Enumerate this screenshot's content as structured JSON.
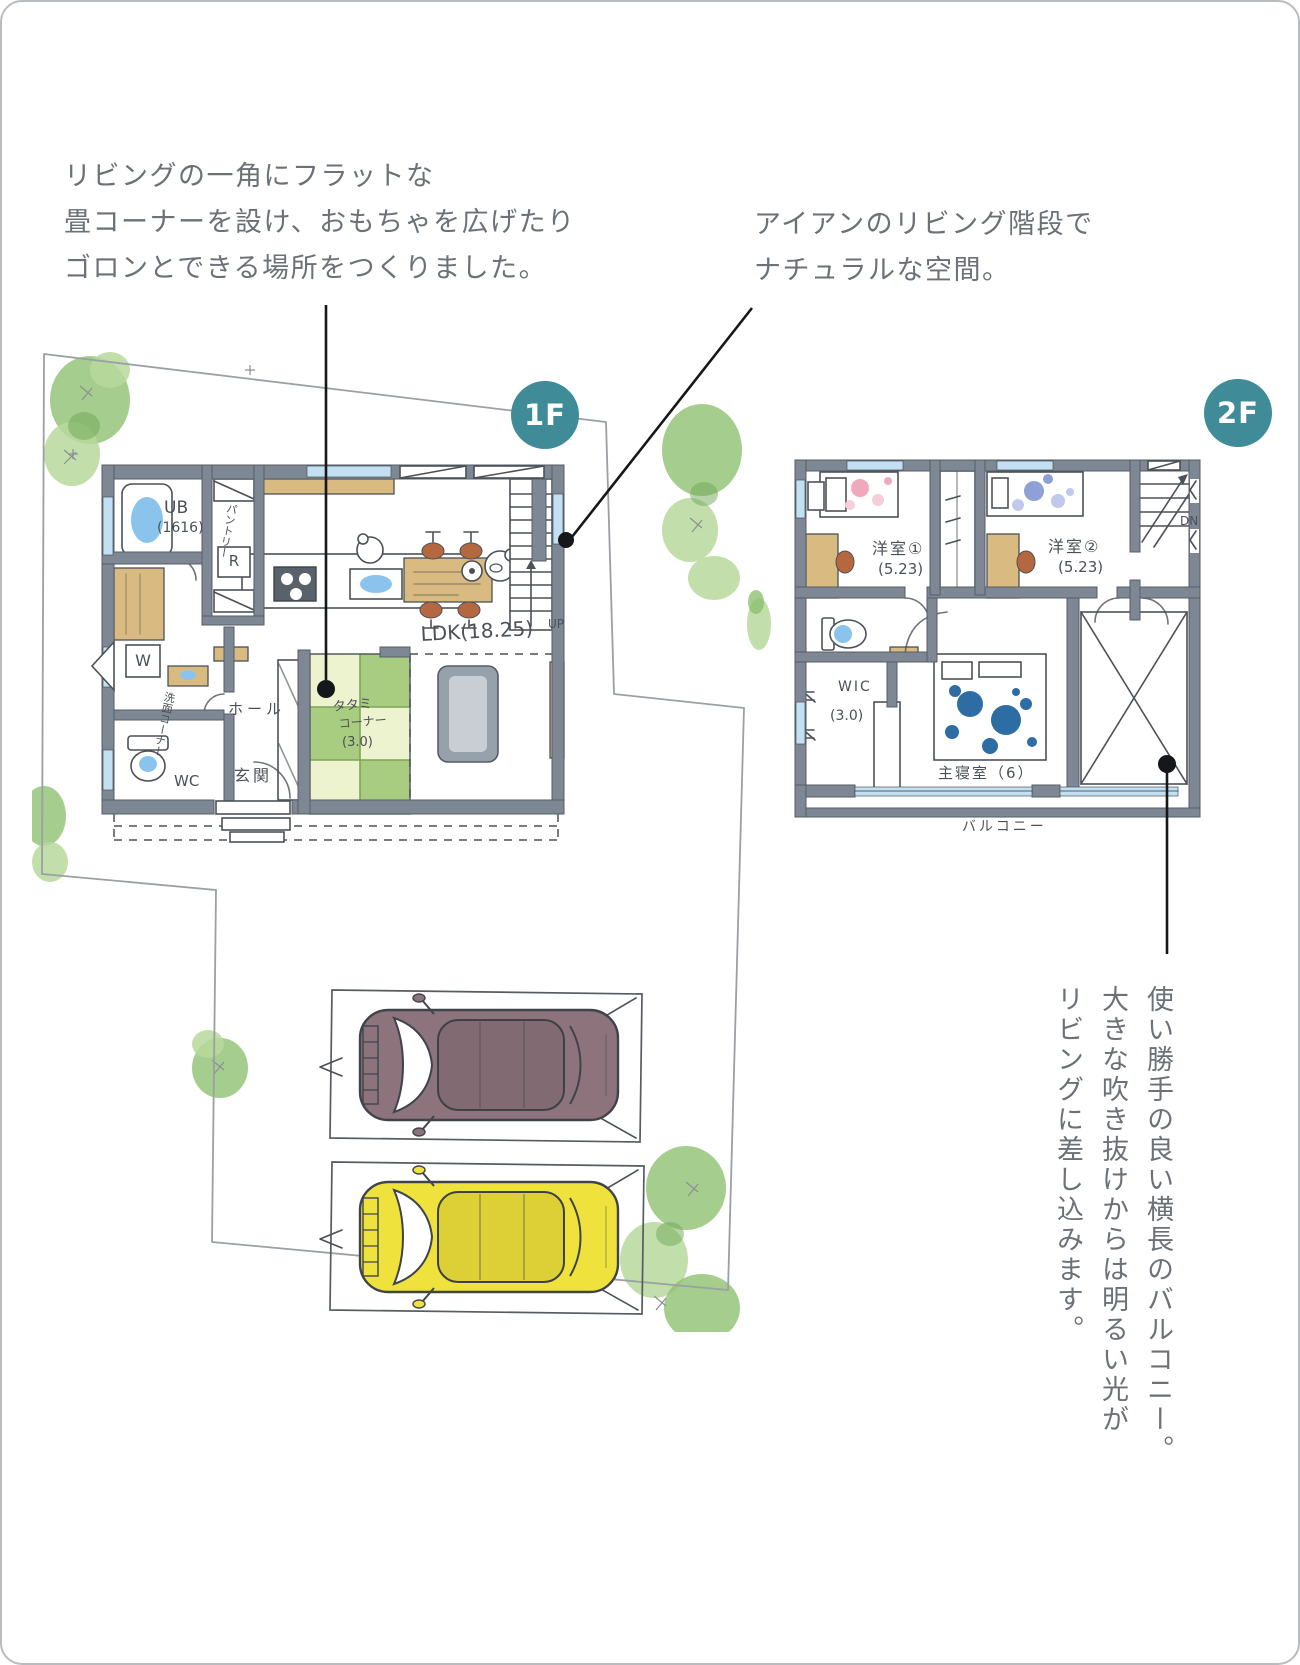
{
  "badges": {
    "floor1": "1F",
    "floor2": "2F"
  },
  "notes": {
    "tatami": {
      "lines": [
        "リビングの一角にフラットな",
        "畳コーナーを設け、おもちゃを広げたり",
        "ゴロンとできる場所をつくりました。"
      ]
    },
    "stairs": {
      "lines": [
        "アイアンのリビング階段で",
        "ナチュラルな空間。"
      ]
    },
    "balcony": {
      "lines": [
        "使い勝手の良い横長のバルコニー。",
        "大きな吹き抜けからは明るい光が",
        "リビングに差し込みます。"
      ]
    }
  },
  "floor1": {
    "labels": {
      "ub": "UB",
      "ub_size": "(1616)",
      "pantry": "パントリー",
      "fridge": "R",
      "washer": "W",
      "sanitary": "洗面コーナー",
      "hall": "ホール",
      "entrance": "玄関",
      "wc": "WC",
      "ldk": "LDK(18.25)",
      "tatami_1": "タタミ",
      "tatami_2": "コーナー",
      "tatami_size": "(3.0)",
      "up": "UP"
    }
  },
  "floor2": {
    "labels": {
      "bedroom1": "洋室①",
      "bedroom1_size": "(5.23)",
      "bedroom2": "洋室②",
      "bedroom2_size": "(5.23)",
      "dn": "DN",
      "wic": "WIC",
      "wic_size": "(3.0)",
      "master": "主寝室（6）",
      "balcony": "バルコニー"
    }
  },
  "colors": {
    "accent": "#3f8b97",
    "wall": "#7e8894",
    "wall_dark": "#565c66",
    "wood": "#d9ba80",
    "tatami_light": "#edf2cf",
    "tatami_green": "#a8cc80",
    "tatami_line": "#7fa457",
    "tree": "#8cbf6d",
    "tree_light": "#b7d89b",
    "water": "#8ac4ec",
    "glass": "#c3e0f2",
    "pink": "#f0a9bc",
    "pink_light": "#f6cdd8",
    "lavender": "#8fa0d6",
    "lavender_light": "#c0c9ea",
    "navy": "#2e6da4",
    "car_brown": "#8d737b",
    "car_yellow": "#f0e23c",
    "ink": "#4b5157",
    "note_text": "#6b7176",
    "site_line": "#9aa0a5"
  }
}
